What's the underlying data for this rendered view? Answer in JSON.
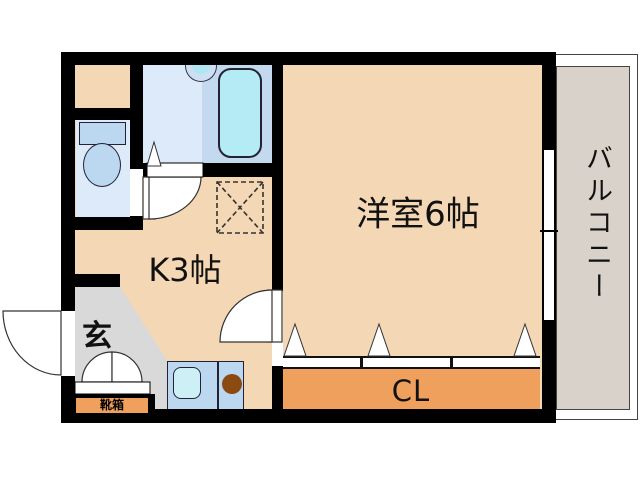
{
  "labels": {
    "main_room": "洋室6帖",
    "kitchen": "K3帖",
    "entrance": "玄",
    "closet": "CL",
    "shoe_box": "靴箱",
    "balcony": "バルコニー"
  },
  "colors": {
    "wall": "#000000",
    "floor": "#f4d7b4",
    "closet_floor": "#efa05c",
    "entrance_floor": "#d9d9d9",
    "balcony_floor": "#d9d2ca",
    "wet_room": "#dceafa",
    "wet_room_dark": "#c3d9ef",
    "fixture_blue": "#bcd7f0",
    "water_cyan": "#b5ebf5",
    "sink_cyan": "#cdeff6",
    "burner_brown": "#8b4a12"
  }
}
